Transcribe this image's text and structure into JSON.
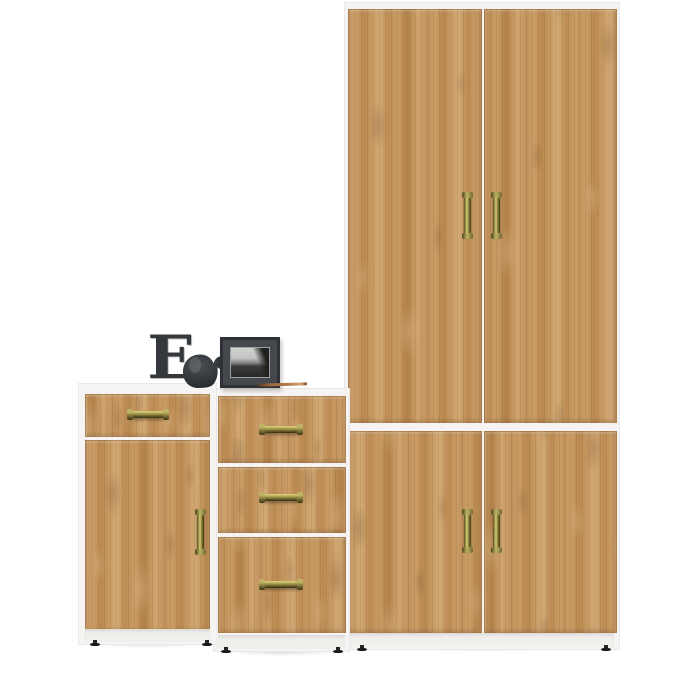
{
  "scene": {
    "items": [
      "base-cabinet-one-drawer-one-door",
      "chest-of-three-drawers",
      "tall-two-section-wardrobe",
      "letter-e-decor-block",
      "elephant-figurine",
      "black-photo-frame",
      "pencil"
    ]
  },
  "decor": {
    "letter": "E"
  },
  "colors": {
    "background": "#ffffff",
    "wood_mid": "#c2925c",
    "wood_dark": "#8f6234",
    "wood_light": "#d9b585",
    "carcass_white": "#f5f4f2",
    "handle_brass": "#8a7f3c",
    "handle_brass_light": "#d6cb74",
    "feet_black": "#1a1a1a",
    "figurine_charcoal": "#34383c",
    "frame_black": "#2e3236",
    "photo_sky_gray": "#d2d2d0",
    "photo_rock_dark": "#272725"
  }
}
